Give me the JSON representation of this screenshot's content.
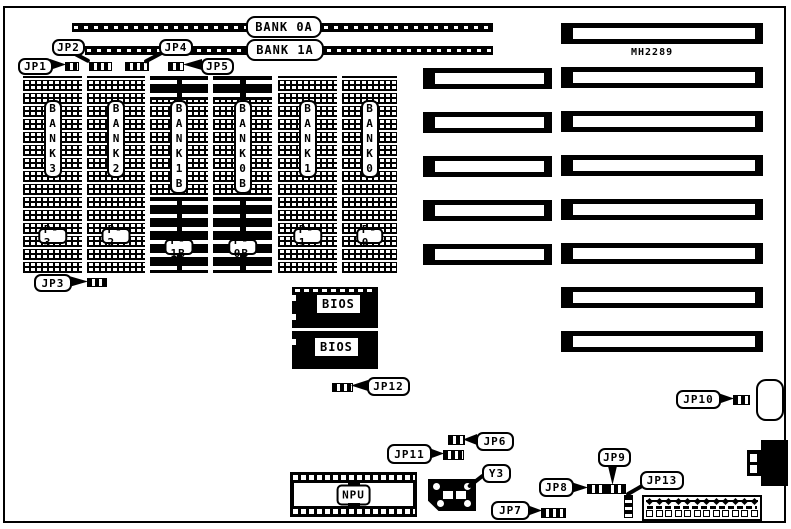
{
  "board": {
    "id": "MH2289",
    "ink": "#000000",
    "paper": "#ffffff"
  },
  "memory": {
    "row_banks": [
      {
        "label": "BANK 0A"
      },
      {
        "label": "BANK 1A"
      }
    ],
    "columns": [
      {
        "bank": "BANK3",
        "pin": "P-3"
      },
      {
        "bank": "BANK2",
        "pin": "P-2"
      },
      {
        "bank": "BANK1B",
        "pin": "P-1B"
      },
      {
        "bank": "BANK0B",
        "pin": "P-0B"
      },
      {
        "bank": "BANK1",
        "pin": "P-1"
      },
      {
        "bank": "BANK0",
        "pin": "P-0"
      }
    ]
  },
  "chips": {
    "bios1": "BIOS",
    "bios2": "BIOS",
    "npu": "NPU",
    "crystal": "Y3"
  },
  "jumpers": {
    "jp1": "JP1",
    "jp2": "JP2",
    "jp3": "JP3",
    "jp4": "JP4",
    "jp5": "JP5",
    "jp6": "JP6",
    "jp7": "JP7",
    "jp8": "JP8",
    "jp9": "JP9",
    "jp10": "JP10",
    "jp11": "JP11",
    "jp12": "JP12",
    "jp13": "JP13"
  }
}
